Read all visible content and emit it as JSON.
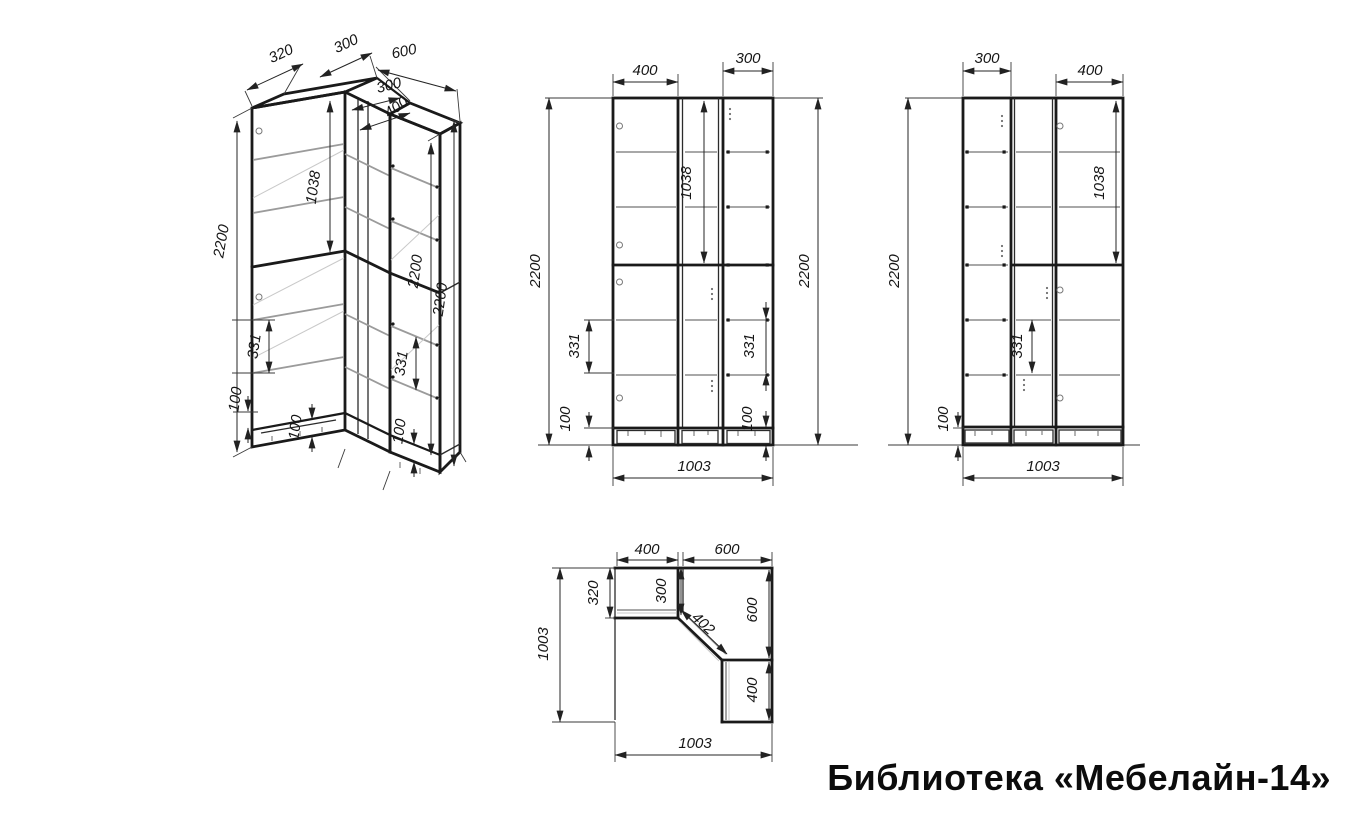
{
  "title": "Библиотека «Мебелайн-14»",
  "colors": {
    "background": "#ffffff",
    "line": "#1a1a1a",
    "shelf_line": "#9b9b9b",
    "text": "#161616"
  },
  "iso": {
    "d320": "320",
    "d300_top": "300",
    "d600": "600",
    "d300_inner": "300",
    "d400_inner": "400",
    "d2200_left": "2200",
    "d1038": "1038",
    "d331_left": "331",
    "d100_left": "100",
    "d100_mid": "100",
    "d100_right": "100",
    "d2200_inner": "2200",
    "d2200_outer": "2200",
    "d331_right": "331"
  },
  "front": {
    "d400": "400",
    "d300": "300",
    "d2200_left": "2200",
    "d2200_right": "2200",
    "d1038": "1038",
    "d331_left": "331",
    "d331_right": "331",
    "d100_left": "100",
    "d100_right": "100",
    "d1003": "1003"
  },
  "side": {
    "d300": "300",
    "d400": "400",
    "d2200": "2200",
    "d100": "100",
    "d331": "331",
    "d1038": "1038",
    "d1003": "1003"
  },
  "plan": {
    "d400_top": "400",
    "d600_top": "600",
    "d320": "320",
    "d300": "300",
    "d402": "402",
    "d600_right": "600",
    "d400_right": "400",
    "d1003_left": "1003",
    "d1003_bottom": "1003"
  }
}
